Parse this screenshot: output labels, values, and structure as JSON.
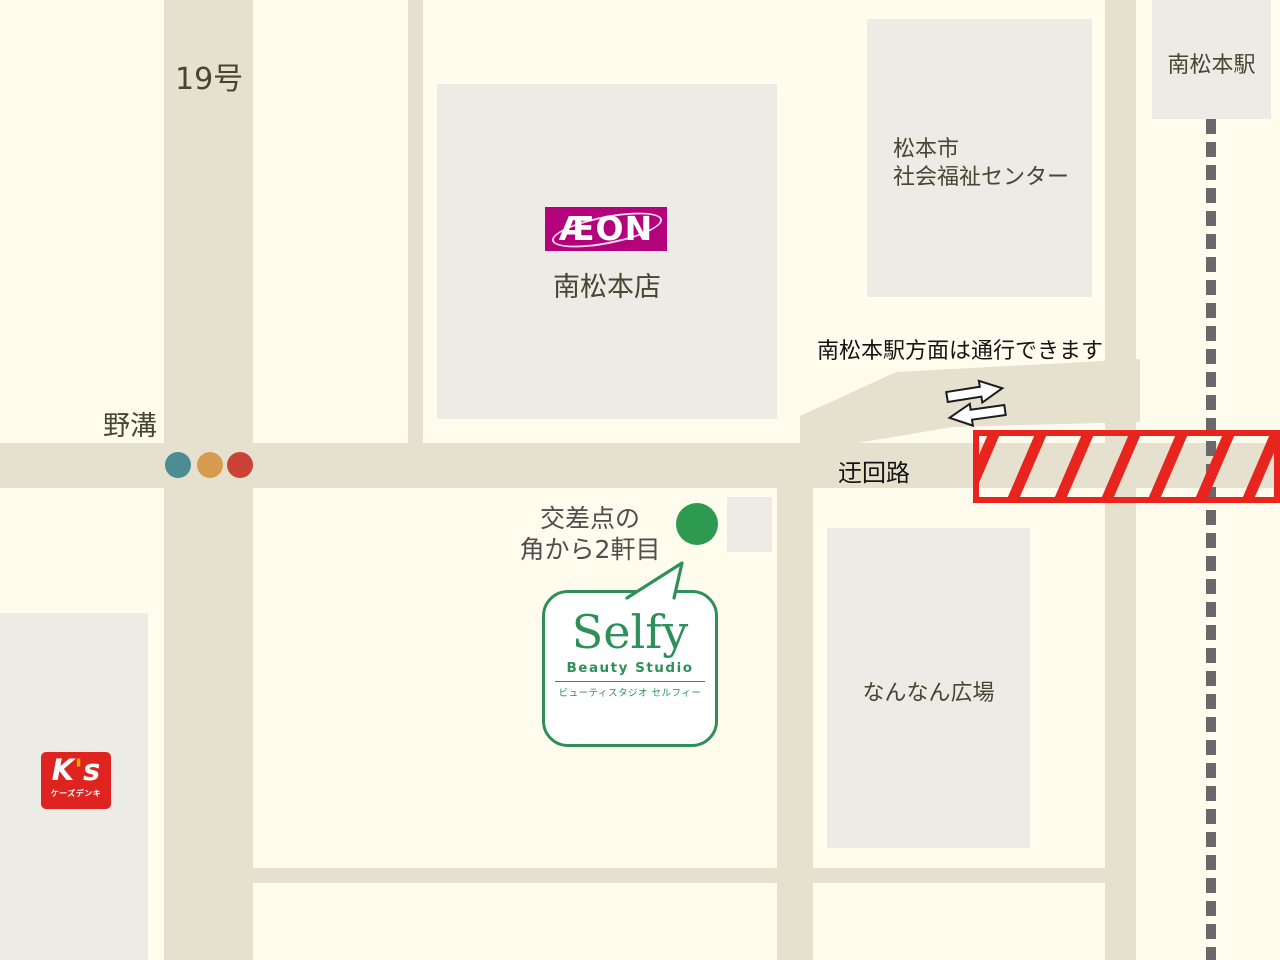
{
  "canvas": {
    "width": 1280,
    "height": 960
  },
  "colors": {
    "background": "#FFFCEE",
    "road": "#E6E1CF",
    "building": "#ECEBE6",
    "label_olive": "#464730",
    "label_black": "#141414",
    "label_gray": "#4E4E4E",
    "selfy_green": "#2E8F58",
    "marker_green": "#2D9A50",
    "signal_teal": "#4A8D92",
    "signal_orange": "#D79B4F",
    "signal_red": "#CB4336",
    "railway_gray": "#6B686B",
    "closure_red": "#E8241E",
    "aeon_magenta": "#B4017C",
    "ks_red": "#DF2420",
    "ks_accent": "#F5A800",
    "arrow_fill": "#FFFFFF",
    "arrow_stroke": "#1C1C1C"
  },
  "roads": {
    "route19_label": "19号",
    "nomizo_label": "野溝",
    "detour_label": "迂回路",
    "passage_note": "南松本駅方面は通行できます"
  },
  "landmarks": {
    "aeon": {
      "logo": "ÆON",
      "name": "南松本店"
    },
    "welfare_center": {
      "line1": "松本市",
      "line2": "社会福祉センター"
    },
    "station": {
      "name": "南松本駅"
    },
    "plaza": {
      "name": "なんなん広場"
    },
    "ks": {
      "logo_k": "K",
      "logo_apos": "'",
      "logo_s": "s",
      "name": "ケーズデンキ"
    }
  },
  "shop": {
    "name": "Selfy",
    "subtitle": "Beauty Studio",
    "kana": "ビューティスタジオ セルフィー",
    "direction_line1": "交差点の",
    "direction_line2": "角から2軒目"
  }
}
